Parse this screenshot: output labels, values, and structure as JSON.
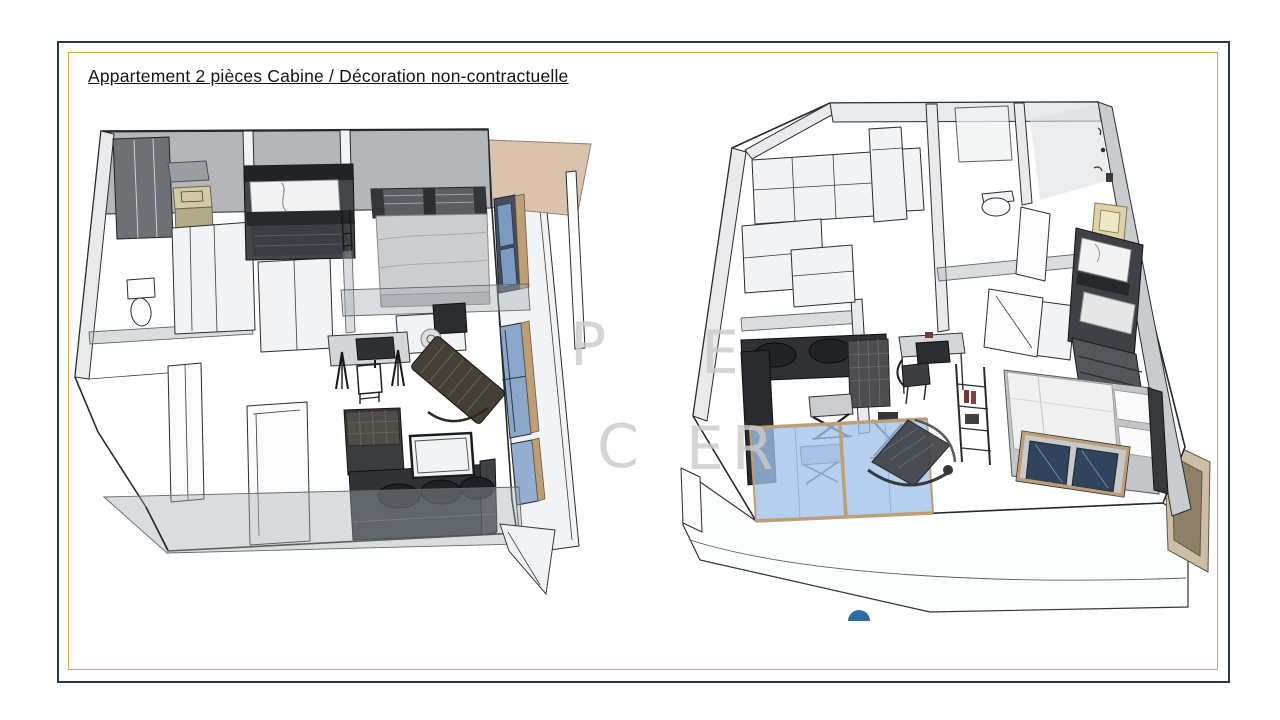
{
  "title": {
    "text": "Appartement 2 pièces Cabine / Décoration non-contractuelle"
  },
  "frame": {
    "outer_border_color": "#23384a",
    "inner_border_color": "#d0a952",
    "background": "#ffffff"
  },
  "watermark": {
    "color": "#cbcbcb",
    "fragments": [
      "P",
      "E",
      "C",
      "ER"
    ]
  },
  "palette": {
    "wall_light": "#e8eaec",
    "wall_medium": "#c9ccce",
    "wall_dark_band": "#b3b7ba",
    "furniture_dark": "#313438",
    "mattress_gray": "#cbcdce",
    "bedding_white": "#f2f2f2",
    "window_blue": "#7d9bc2",
    "balcony_glass_blue": "#a9c5e5",
    "wood_frame": "#bd9e76",
    "canopy_tan": "#d9c3ac",
    "vanity_beige": "#d2c9a6",
    "picture_frame_beige": "#ddd3a6",
    "terrace_pillar_tan": "#cbbda6",
    "accent_semicircle_blue": "#2e6da4",
    "bottle_red": "#7c3434",
    "shower_gray": "#6d7075"
  }
}
